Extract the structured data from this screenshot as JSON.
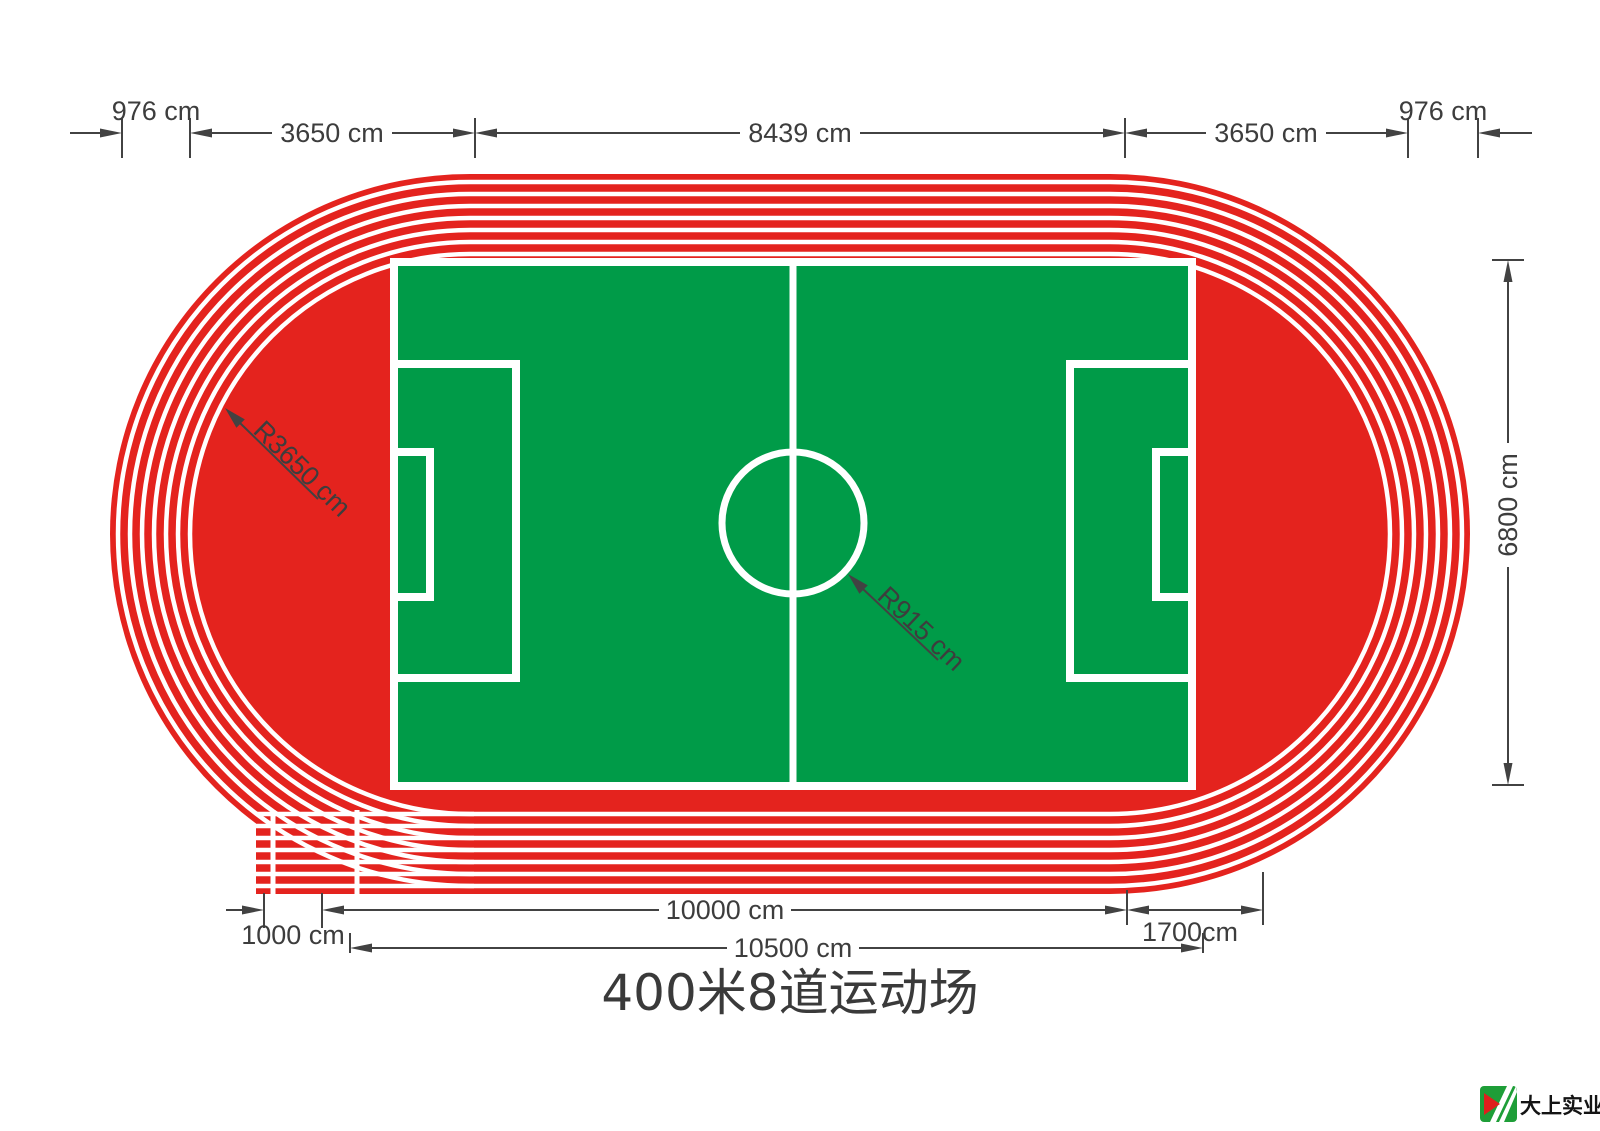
{
  "title": "400米8道运动场",
  "colors": {
    "track_red": "#E4231E",
    "field_green": "#009B48",
    "line_white": "#FFFFFF",
    "dim_gray": "#424242",
    "logo_green": "#1E9E38",
    "logo_red": "#DF1F1C"
  },
  "dimensions": {
    "top": {
      "track_width_left": "976 cm",
      "curve_left": "3650 cm",
      "straight": "8439 cm",
      "curve_right": "3650 cm",
      "track_width_right": "976 cm"
    },
    "right": {
      "field_height": "6800 cm"
    },
    "bottom": {
      "chute": "1000 cm",
      "straight_total": "10000 cm",
      "curve_offset": "1700cm",
      "overall": "10500 cm"
    },
    "radius": {
      "track_inner": "R3650 cm",
      "center_circle": "R915 cm"
    }
  },
  "logo": {
    "company": "大上实业"
  }
}
